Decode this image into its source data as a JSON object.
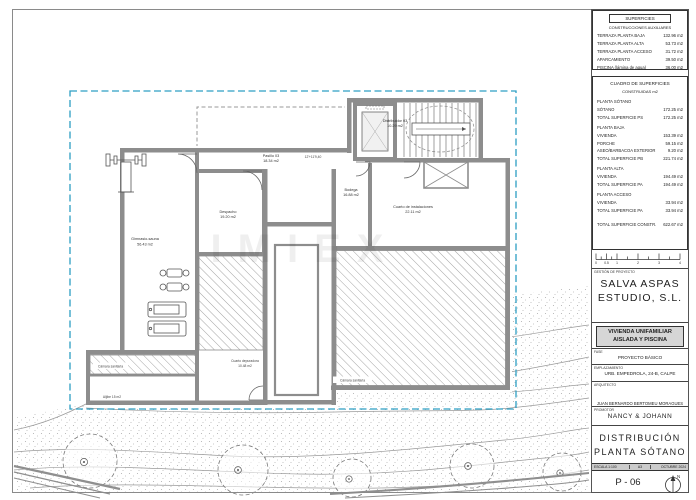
{
  "sheet": {
    "aux_table": {
      "title": "SUPERFICIES",
      "subtitle": "CONSTRUCCIONES AUXILIARES",
      "rows": [
        {
          "label": "TERRAZA PLANTA BAJA",
          "value": "132.96 m2"
        },
        {
          "label": "TERRAZA PLANTA ALTA",
          "value": "53.73 m2"
        },
        {
          "label": "TERRAZA PLANTA ACCESO",
          "value": "31.72 m2"
        },
        {
          "label": "APARCAMIENTO",
          "value": "39.50 m2"
        },
        {
          "label": "PISCINA (lámina de agua)",
          "value": "36.00 m2"
        }
      ]
    },
    "areas_table": {
      "title": "CUADRO DE SUPERFICIES",
      "subtitle": "CONSTRUIDAS m2",
      "sections": [
        {
          "header": "PLANTA SÓTANO",
          "rows": [
            {
              "label": "SÓTANO",
              "value": "172.25 m2"
            },
            {
              "label": "TOTAL SUPERFICIE PS",
              "value": "172.25 m2"
            }
          ]
        },
        {
          "header": "PLANTA BAJA",
          "rows": [
            {
              "label": "VIVIENDA",
              "value": "153.39 m2"
            },
            {
              "label": "PORCHE",
              "value": "59.15 m2"
            },
            {
              "label": "ASEO/BARBACOA EXTERIOR",
              "value": "9.20 m2"
            },
            {
              "label": "TOTAL SUPERFICIE PB",
              "value": "221.74 m2"
            }
          ]
        },
        {
          "header": "PLANTA ALTA",
          "rows": [
            {
              "label": "VIVIENDA",
              "value": "194.49 m2"
            },
            {
              "label": "TOTAL SUPERFICIE PA",
              "value": "194.49 m2"
            }
          ]
        },
        {
          "header": "PLANTA ACCESO",
          "rows": [
            {
              "label": "VIVIENDA",
              "value": "33.94 m2"
            },
            {
              "label": "TOTAL SUPERFICIE PA",
              "value": "33.94 m2"
            }
          ]
        }
      ],
      "total": {
        "label": "TOTAL SUPERFICIE CONSTR.",
        "value": "622.67 m2"
      }
    },
    "scalebar": [
      "0",
      "0.5",
      "1",
      "2",
      "3",
      "4"
    ],
    "firm": {
      "label": "GESTIÓN DE PROYECTO",
      "line1": "SALVA ASPAS",
      "line2": "ESTUDIO, S.L."
    },
    "project": {
      "line1": "VIVIENDA UNIFAMILIAR",
      "line2": "AISLADA Y PISCINA"
    },
    "fase": {
      "label": "FASE",
      "value": "PROYECTO BÁSICO"
    },
    "emplazamiento": {
      "label": "EMPLAZAMIENTO",
      "value": "URB. EMPEDROLA, 24-B, CALPE"
    },
    "arquitecto": {
      "label": "ARQUITECTO",
      "value": "JUAN BERNARDO BERTOMEU MORAGUES"
    },
    "promotor": {
      "label": "PROMOTOR",
      "value": "NANCY & JOHANN"
    },
    "title": {
      "line1": "DISTRIBUCIÓN",
      "line2": "PLANTA SÓTANO"
    },
    "meta": {
      "escala": "ESCALA 1:100",
      "formato": "A3",
      "fecha": "OCTUBRE 2024"
    },
    "sheet_number": "P - 06",
    "north_label": "N",
    "accent_color": "#2d9fc4"
  },
  "plan": {
    "labels": {
      "distribuidor": {
        "name": "Distribuidor 03",
        "area": "10.29 m2"
      },
      "pasillo": {
        "name": "Pasillo 03",
        "area": "18.34 m2"
      },
      "level_mark": "12'+11'9,40",
      "despacho": {
        "name": "Despacho",
        "area": "19.20 m2"
      },
      "gimnasio": {
        "name": "Gimnasio-sauna",
        "area": "56.43 m2"
      },
      "instalaciones": {
        "name": "Cuarto de instalaciones",
        "area": "22.11 m2"
      },
      "bodega": {
        "name": "Bodega",
        "area": "16.88 m2"
      },
      "camara_derecha": "Cámara sanitaria",
      "camara_izquierda": "Cámara sanitaria",
      "aljibe": "Aljibe 15 m2",
      "depuradora": {
        "name": "Cuarto depuradora",
        "area": "10.48 m2"
      }
    },
    "watermark": "IMIEX"
  }
}
